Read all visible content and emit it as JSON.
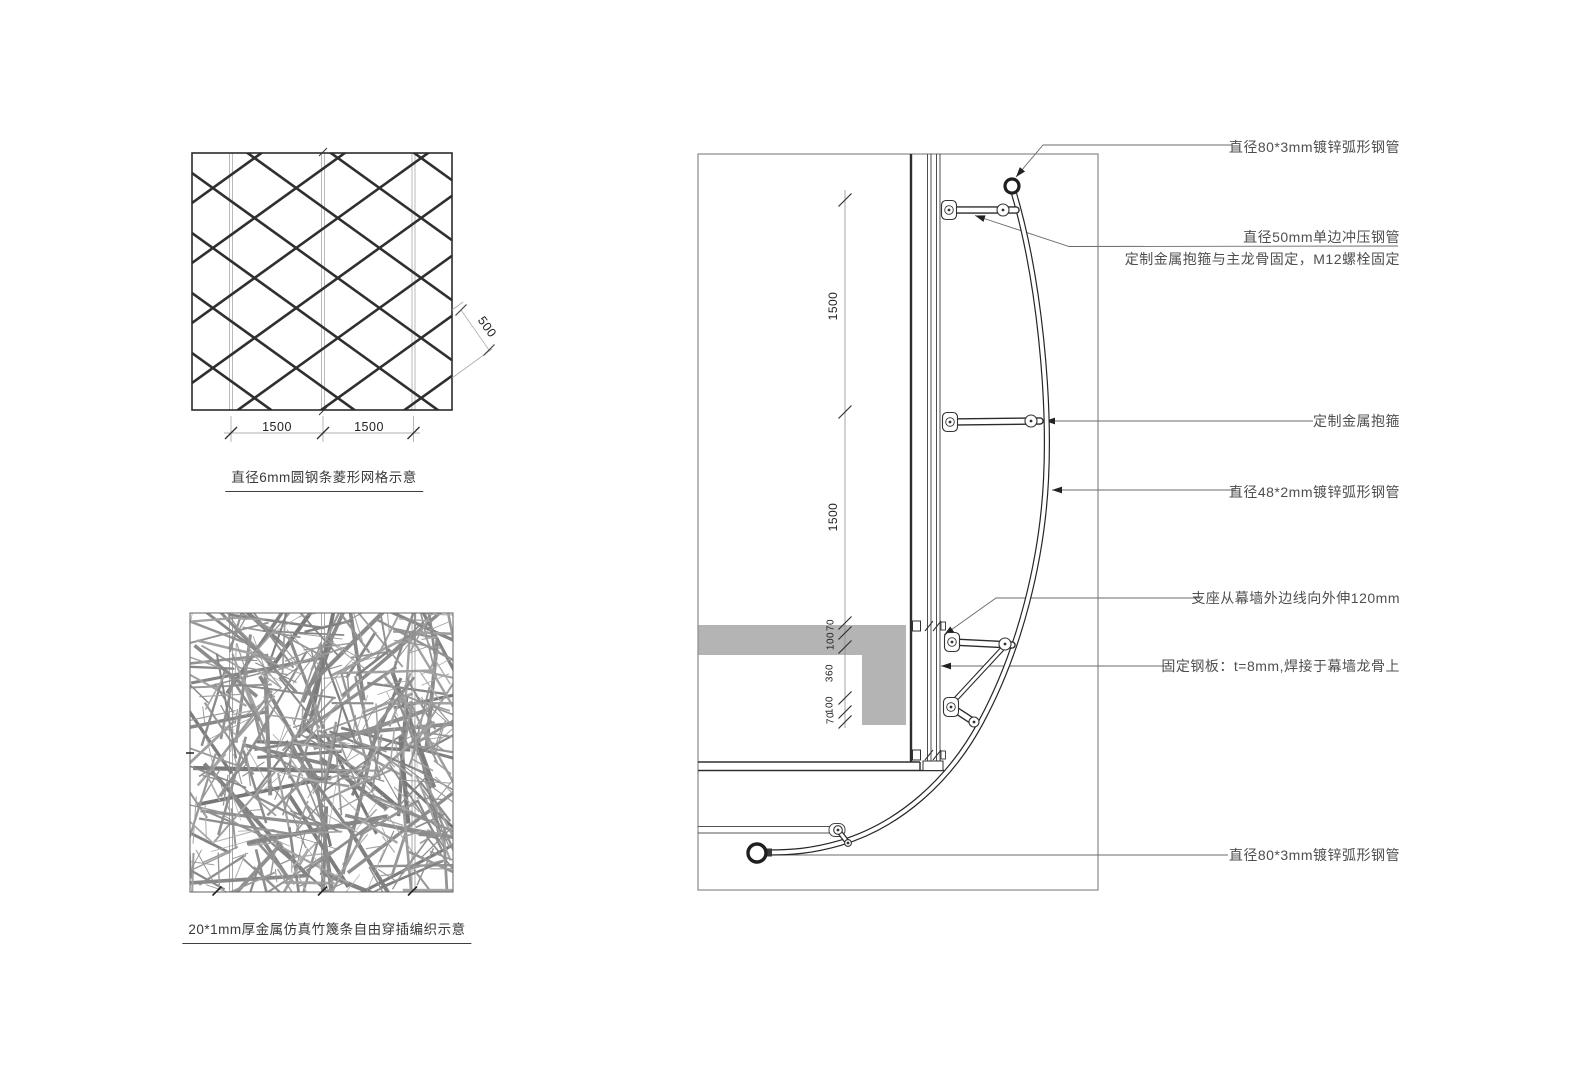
{
  "left_panels": {
    "grid_panel": {
      "caption": "直径6mm圆钢条菱形网格示意",
      "dims": {
        "bottom_left": "1500",
        "bottom_right": "1500",
        "diagonal": "500"
      }
    },
    "weave_panel": {
      "caption": "20*1mm厚金属仿真竹篾条自由穿插编织示意"
    }
  },
  "detail_view": {
    "dim_chain": [
      "1500",
      "1500",
      "70",
      "100",
      "360",
      "100",
      "70"
    ],
    "callouts": {
      "top_pipe": "直径80*3mm镀锌弧形钢管",
      "strut_pipe": "直径50mm单边冲压钢管",
      "strut_pipe_line2": "定制金属抱箍与主龙骨固定，M12螺栓固定",
      "clamp": "定制金属抱箍",
      "arc_pipe": "直径48*2mm镀锌弧形钢管",
      "support": "支座从幕墙外边线向外伸120mm",
      "plate": "固定钢板：t=8mm,焊接于幕墙龙骨上",
      "bottom_pipe": "直径80*3mm镀锌弧形钢管"
    }
  },
  "colors": {
    "line_dark": "#2b2b2b",
    "line_gray": "#8a8a8a",
    "leader_gray": "#6b6b6b",
    "slab_gray": "#b4b4b4",
    "lattice": "#2f2f2f",
    "weave_gray": "#969696",
    "text": "#4a4a4a"
  }
}
